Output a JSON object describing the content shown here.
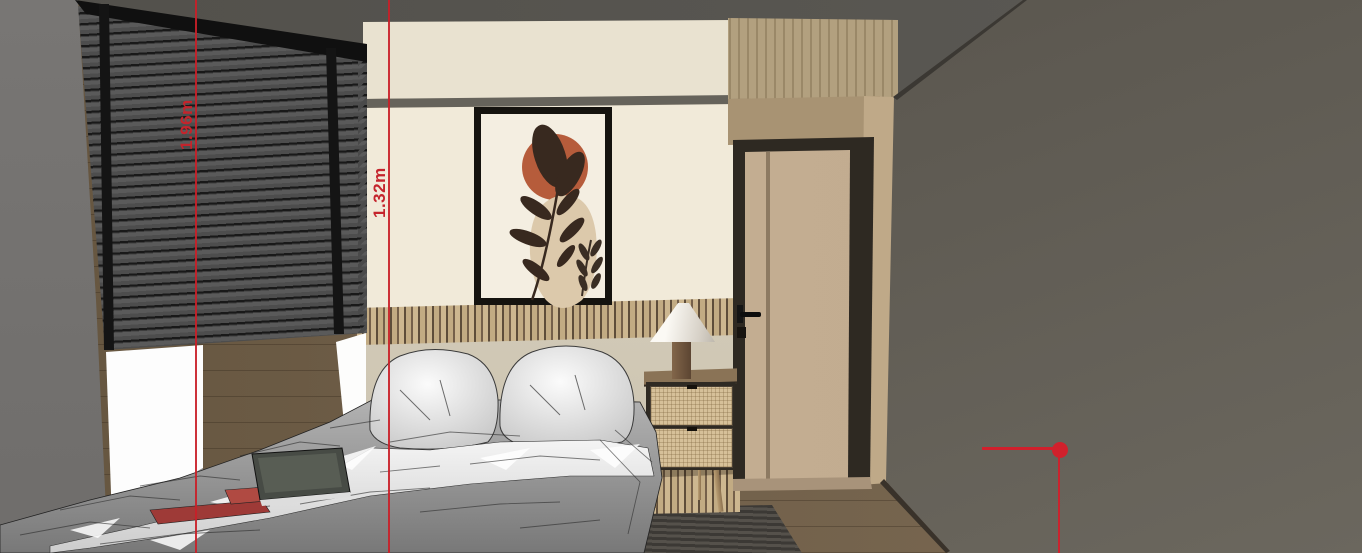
{
  "viewport": {
    "type": "3d-interior-render",
    "room": "bedroom",
    "style": "sketchup-shaded-with-edges"
  },
  "dimension_guides": [
    {
      "id": "guide-1",
      "label": "1.96m",
      "orientation": "vertical",
      "color": "#c4242c"
    },
    {
      "id": "guide-2",
      "label": "1.32m",
      "orientation": "vertical",
      "color": "#c4242c"
    }
  ],
  "axis_marker": {
    "shape": "dot-with-horizontal-and-vertical-line",
    "color": "#d1202c"
  },
  "palette": {
    "ceiling": "#555350",
    "left_wall": "#747271",
    "right_wall": "#5e5a52",
    "back_wall": "#f1ead9",
    "back_wall_band": "#e9e2d0",
    "blinds": "#4d4d4d",
    "pelmet": "#101010",
    "window_light": "#fdfdfd",
    "slat_panel_light": "#c2ab83",
    "slat_panel_dark": "#5e4d3a",
    "door": "#c2ac90",
    "door_frame": "#2e2922",
    "wood_panel": "#b2a07f",
    "floor": "#71604a",
    "rug": "#4a463f",
    "nightstand_rattan": "#d6c099",
    "lamp_shade": "#f5f2ec",
    "art_terracotta": "#b65c3b",
    "art_beige": "#dcc9ab",
    "art_leaf": "#38291f",
    "bedding_gray": "#9c9c9c",
    "bedding_white": "#efefef"
  },
  "objects": {
    "labels": [
      "ceiling",
      "left wall",
      "venetian blinds",
      "window",
      "back wall",
      "wall art",
      "wood slat panel",
      "headboard",
      "bed",
      "pillows",
      "book",
      "magazine",
      "nightstand",
      "table lamp",
      "door",
      "wood paneling",
      "right wall",
      "floor",
      "rug"
    ]
  }
}
